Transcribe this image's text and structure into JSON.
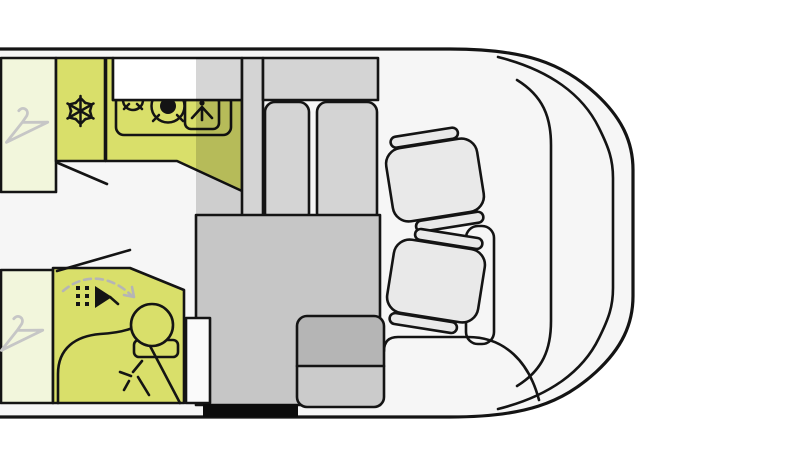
{
  "diagram": {
    "type": "motorhome-floor-plan-top-view",
    "vehicle": {
      "cab": {
        "seats": [
          {
            "name": "driver-seat",
            "style": "swivel-with-armrests"
          },
          {
            "name": "passenger-seat",
            "style": "swivel-with-armrests"
          }
        ],
        "elements": [
          "windshield-line",
          "dashboard-line",
          "center-console",
          "cab-step-line"
        ]
      },
      "living_area": {
        "kitchen": {
          "elements": [
            "fridge",
            "counter",
            "hob",
            "sink"
          ],
          "icons": [
            "snowflake-icon",
            "burner-small-icon",
            "burner-large-icon",
            "tap-spray-icon"
          ],
          "door_swing_lines": 1
        },
        "dinette": {
          "elements": [
            "side-panel",
            "top-sideboard",
            "seat-cushion-left",
            "seat-cushion-right"
          ]
        },
        "bathroom": {
          "elements": [
            "shower",
            "washbasin",
            "swivel-wall"
          ],
          "icons": [
            "shower-spray-icon",
            "swivel-arrow-icon",
            "fold-spark-icon"
          ],
          "door_swing_lines": 1
        },
        "storage": {
          "elements": [
            "rear-wardrobe-top",
            "rear-wardrobe-bottom"
          ],
          "icons": [
            "coat-hanger-icon",
            "coat-hanger-icon"
          ]
        },
        "floor": {
          "elements": [
            "center-furniture-block",
            "two-tone-bench",
            "entry-step-white",
            "entry-step-black"
          ]
        }
      }
    },
    "colors": {
      "outline": "#141414",
      "body_fill": "#f6f6f6",
      "cab_floor": "#fafafa",
      "accent_bright": "#d9df6a",
      "accent_pale": "#f2f6dc",
      "gray_light": "#d4d4d4",
      "gray_mid": "#c6c6c6",
      "gray_dark": "#b5b5b5",
      "gray_lower": "#cbcbcb",
      "seat_fill": "#e9e9e9",
      "hanger_gray": "#c6c6c6",
      "arrow_gray": "#b5b5b5",
      "step_black": "#0c0c0c",
      "shadow": "rgba(0,0,0,0.16)"
    }
  }
}
